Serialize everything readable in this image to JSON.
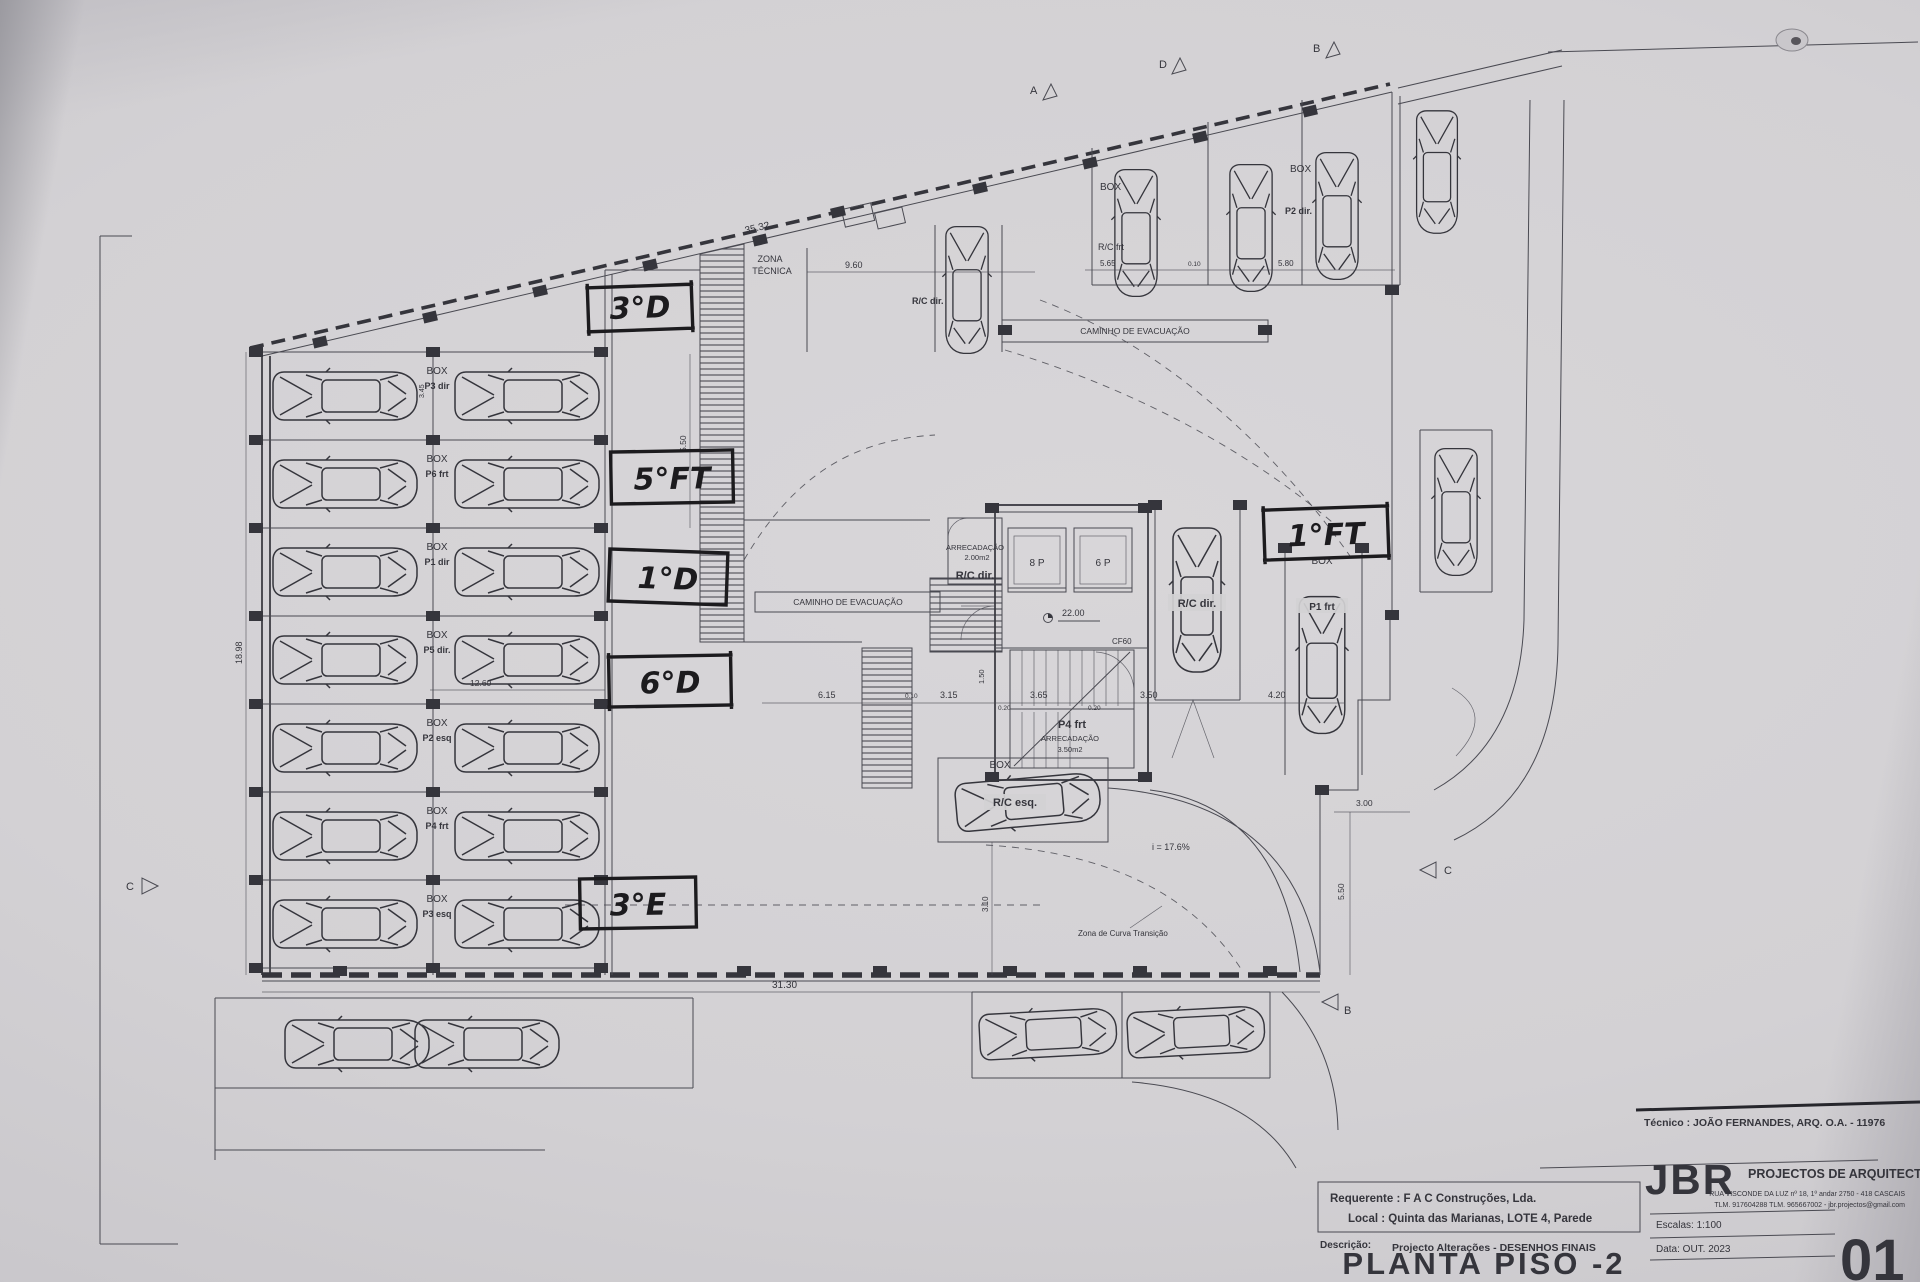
{
  "colors": {
    "paper": "#d3d1d4",
    "ink": "#4a4a52",
    "ink2": "#35353c",
    "hand": "#1c1b1e"
  },
  "titleblock": {
    "tecnico": "Técnico : JOÃO FERNANDES, ARQ.   O.A. - 11976",
    "firm": "JBR",
    "firm_suffix": "PROJECTOS DE ARQUITECTURA",
    "firm_address": "RUA VISCONDE DA LUZ nº 18, 1º andar  2750 - 418  CASCAIS",
    "firm_contact": "TLM. 917604288  TLM. 965667002 - jbr.projectos@gmail.com",
    "requerente": "Requerente : F A C  Construções, Lda.",
    "local": "Local : Quinta das Marianas, LOTE 4, Parede",
    "descricao_label": "Descrição:",
    "descricao": "Projecto Alterações - DESENHOS FINAIS",
    "title": "PLANTA PISO -2",
    "escala": "Escalas:  1:100",
    "data": "Data: OUT.  2023",
    "sheet": "01"
  },
  "annotations": {
    "d3": "3°D",
    "ft5": "5°FT",
    "d1": "1°D",
    "d6": "6°D",
    "e3": "3°E",
    "ft1": "1°FT"
  },
  "labels": {
    "box": "BOX",
    "zona1": "ZONA",
    "zona2": "TÉCNICA",
    "caminho": "CAMINHO DE EVACUAÇÃO",
    "rc_frt": "R/C frt",
    "rc_dir": "R/C dir.",
    "rc_esq": "R/C esq.",
    "p2_dir": "P2 dir.",
    "p1_frt": "P1 frt",
    "p4_frt": "P4 frt",
    "arrecadacao": "ARRECADAÇÃO",
    "arrecadacao_area": "2.00m2",
    "arrecadacao2_area": "3.50m2",
    "lift_8p": "8 P",
    "lift_6p": "6 P",
    "cf60": "CF60",
    "level": "22.00",
    "slope": "i = 17.6%",
    "curve_zone": "Zona de Curva Transição",
    "stall_rows": [
      "P3 dir",
      "P6 frt",
      "P1 dir",
      "P5 dir.",
      "P2 esq",
      "P4 frt",
      "P3 esq"
    ]
  },
  "dims": {
    "slant_top": "35.32",
    "top_inner": "9.60",
    "tr_1": "5.65",
    "tr_2": "0.10",
    "tr_3": "5.80",
    "mid_1": "6.15",
    "mid_2": "3.15",
    "mid_3": "3.65",
    "mid_4": "3.50",
    "mid_5": "4.20",
    "mid_s1": "0.10",
    "mid_s2": "0.20",
    "mid_s3": "0.20",
    "left_v": "18.98",
    "row_w": "12.60",
    "bottom": "31.30",
    "ramp_v": "5.50",
    "right_v": "5.50",
    "core_v": "1.50",
    "low_v": "3.10",
    "right_h": "3.00",
    "stall_d": "3.45"
  },
  "markers": {
    "m1": "A",
    "m2": "D",
    "m3": "B",
    "m4": "C",
    "m5": "C",
    "m6": "B"
  }
}
